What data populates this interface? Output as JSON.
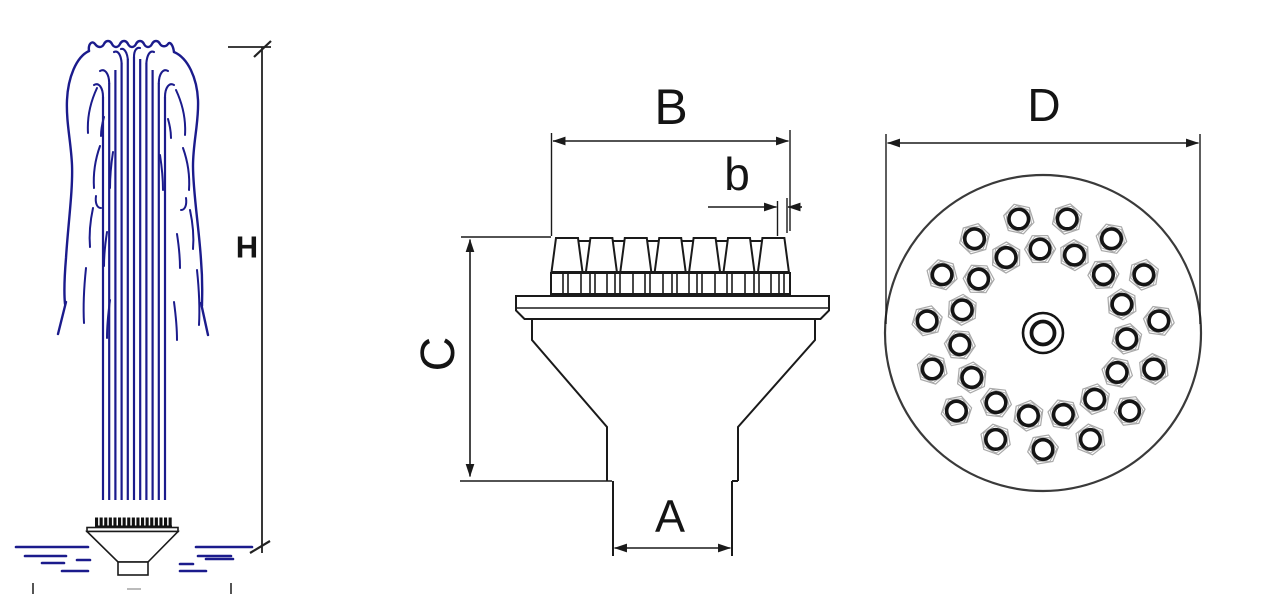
{
  "drawing": {
    "type": "fountain-nozzle-technical-drawing",
    "views": [
      "spray-elevation",
      "side-section",
      "top-plan"
    ]
  },
  "labels": {
    "spray_height": "H",
    "head_outer_width": "B",
    "single_nozzle_width": "b",
    "body_height": "C",
    "inlet_width": "A",
    "head_diameter": "D"
  },
  "colors": {
    "water_blue": "#1b1b8c",
    "drawing_black": "#1a1a1a",
    "nut_gray": "#a9a9a9",
    "circle_gray": "#3a3a3a"
  },
  "left_view": {
    "jet_count": 11,
    "jet_x_start": 103,
    "jet_x_step": 6.2,
    "jet_top_y": [
      97,
      83,
      70,
      63,
      59,
      57,
      59,
      63,
      70,
      83,
      97
    ],
    "jet_bottom_y": 500,
    "water_dashes": [
      [
        16,
        547,
        88
      ],
      [
        25,
        556,
        66
      ],
      [
        77,
        560,
        90
      ],
      [
        42,
        563,
        64
      ],
      [
        62,
        571,
        88
      ],
      [
        196,
        547,
        252
      ],
      [
        198,
        556,
        231
      ],
      [
        206,
        559,
        233
      ],
      [
        180,
        564,
        193
      ],
      [
        180,
        571,
        206
      ]
    ],
    "teeth_count": 17
  },
  "side_view": {
    "front_nozzles": {
      "count": 7,
      "first_cx": 567,
      "step": 34.4,
      "bottom_half_w": 15.5,
      "top_half_w": 11,
      "top_y": 238,
      "bottom_y": 272
    },
    "back_nozzles": {
      "count": 6,
      "first_cx": 584.2,
      "step": 34.4,
      "bottom_half_w": 13,
      "top_half_w": 8,
      "top_y": 241,
      "bottom_y": 272
    },
    "nut_row": {
      "x1": 551,
      "x2": 790,
      "y1": 273,
      "y2": 294,
      "gaps": [
        12,
        5,
        13,
        9,
        5,
        12,
        8,
        5,
        13
      ]
    }
  },
  "top_view": {
    "center": [
      1043,
      333
    ],
    "radius": 158,
    "rings": [
      {
        "name": "outer",
        "count": 15,
        "radius": 116.5,
        "start_deg": 6,
        "step_deg": 24
      },
      {
        "name": "inner",
        "count": 15,
        "radius": 84,
        "start_deg": 20,
        "step_deg": 24
      }
    ],
    "nozzle": {
      "circle_r": 9.8,
      "stroke_w": 3.6,
      "hex_r1": 15.5,
      "hex_r2": 13.6
    },
    "center_nozzle": {
      "outer_r": 20,
      "outer_w": 2.6,
      "inner_r": 11.5,
      "inner_w": 3.8
    }
  }
}
